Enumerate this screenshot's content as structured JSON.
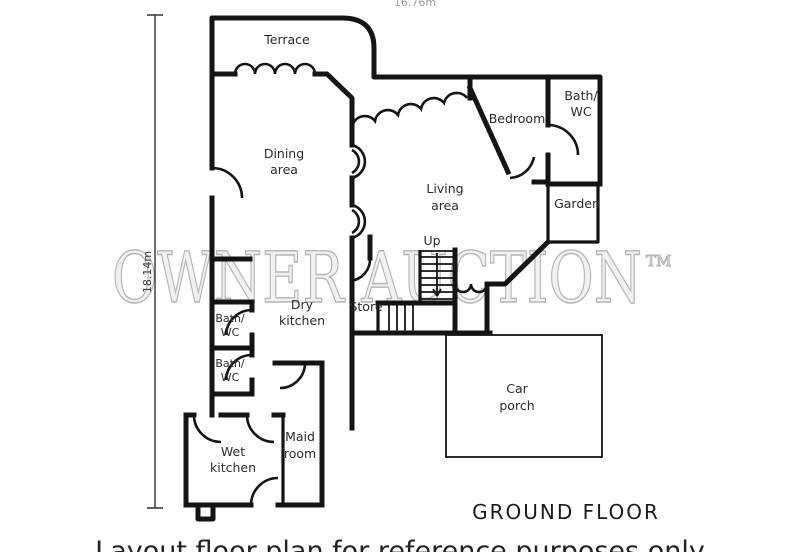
{
  "watermark": {
    "text": "OWNER AUCTION",
    "tm": "TM"
  },
  "dimensions": {
    "left": "18.14m",
    "top": "16.76m"
  },
  "rooms": {
    "terrace": "Terrace",
    "dining": [
      "Dining",
      "area"
    ],
    "living": [
      "Living",
      "area"
    ],
    "bedroom": "Bedroom",
    "bath_wc_upper": [
      "Bath/",
      "WC"
    ],
    "garden": "Garden",
    "up": "Up",
    "dry_kitchen": [
      "Dry",
      "kitchen"
    ],
    "store": "Store",
    "bath_wc_1": [
      "Bath/",
      "WC"
    ],
    "bath_wc_2": [
      "Bath/",
      "WC"
    ],
    "wet_kitchen": [
      "Wet",
      "kitchen"
    ],
    "maid_room": [
      "Maid",
      "room"
    ],
    "car_porch": [
      "Car",
      "porch"
    ]
  },
  "footer": {
    "floor_label": "GROUND FLOOR",
    "caption": "Layout floor plan for reference purposes only"
  },
  "colors": {
    "wall": "#141414",
    "watermark_fill": "#f1f1f1",
    "watermark_stroke": "#b5b5b5",
    "background": "#ffffff"
  }
}
